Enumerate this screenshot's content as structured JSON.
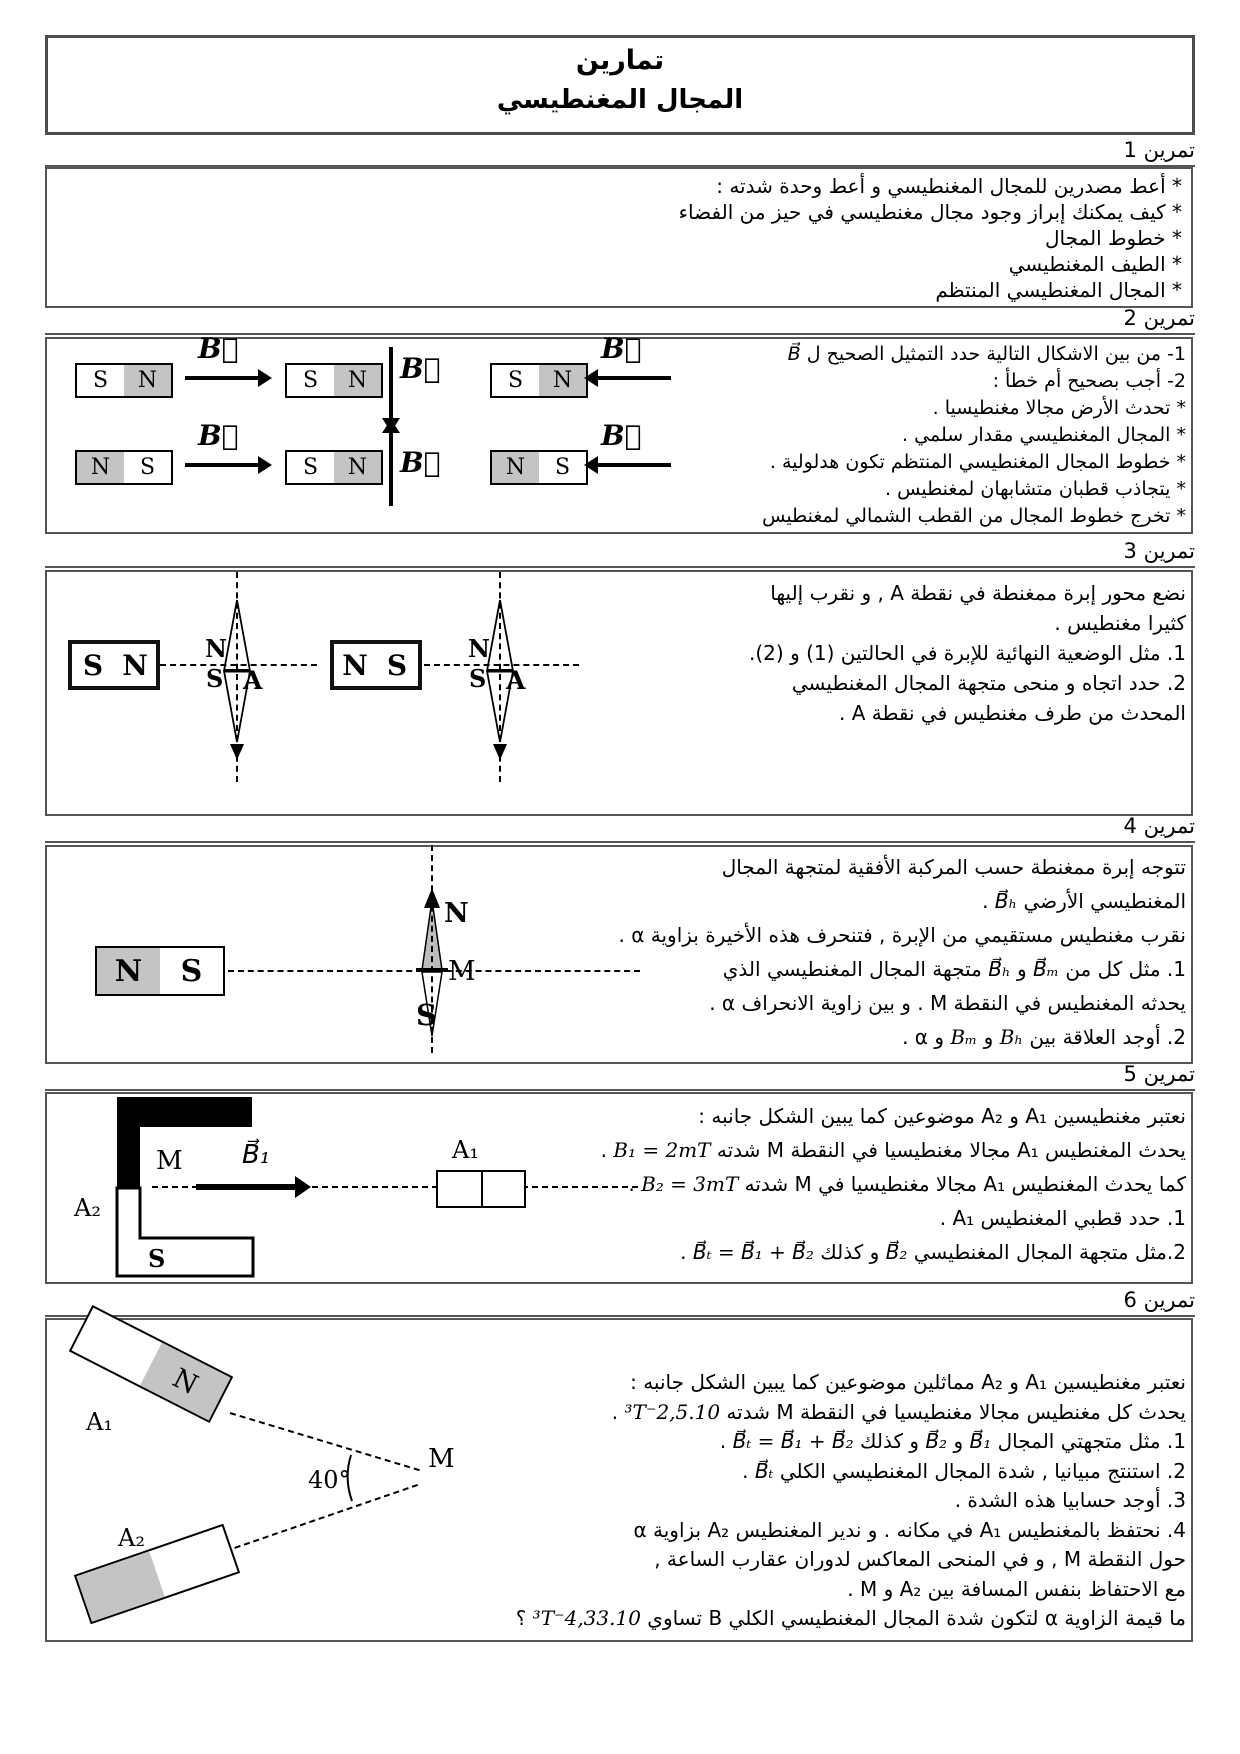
{
  "labels": {
    "vec_b": "B⃗"
  },
  "title": {
    "line1": "تمارين",
    "line2": "المجال المغنطيسي"
  },
  "ex1": {
    "heading": "تمرين 1",
    "lines": [
      {
        "t": "* أعط مصدرين للمجال المغنطيسي و أعط وحدة شدته :"
      },
      {
        "t": "* كيف يمكنك إبراز وجود مجال مغنطيسي في حيز من الفضاء"
      },
      {
        "t": "* خطوط المجال"
      },
      {
        "t": "* الطيف المغنطيسي"
      },
      {
        "t": "* المجال المغنطيسي المنتظم"
      }
    ]
  },
  "ex2": {
    "heading": "تمرين 2",
    "lines": [
      {
        "a": "1- من بين الاشكال التالية حدد التمثيل الصحيح ل ",
        "f": "B⃗"
      },
      {
        "t": "2- أجب بصحيح أم خطأ :"
      },
      {
        "t": "* تحدث الأرض مجالا مغنطيسيا ."
      },
      {
        "t": "* المجال المغنطيسي مقدار سلمي ."
      },
      {
        "t": "* خطوط المجال المغنطيسي المنتظم تكون هدلولية ."
      },
      {
        "t": "* يتجاذب قطبان متشابهان لمغنطيس ."
      },
      {
        "t": "* تخرج خطوط المجال من القطب الشمالي لمغنطيس"
      }
    ],
    "magnets": [
      {
        "left": "S",
        "right": "N",
        "shaded": "right",
        "arrow": "right"
      },
      {
        "left": "S",
        "right": "N",
        "shaded": "right",
        "arrow": "down"
      },
      {
        "left": "S",
        "right": "N",
        "shaded": "right",
        "arrow": "left"
      },
      {
        "left": "N",
        "right": "S",
        "shaded": "left",
        "arrow": "right"
      },
      {
        "left": "S",
        "right": "N",
        "shaded": "right",
        "arrow": "up"
      },
      {
        "left": "N",
        "right": "S",
        "shaded": "left",
        "arrow": "left"
      }
    ]
  },
  "ex3": {
    "heading": "تمرين 3",
    "lines": [
      {
        "t": "نضع محور إبرة ممغنطة في نقطة A , و نقرب إليها"
      },
      {
        "t": "كثيرا مغنطيس ."
      },
      {
        "t": "1. مثل الوضعية النهائية للإبرة في الحالتين (1) و (2)."
      },
      {
        "t": "2. حدد اتجاه و منحى متجهة المجال المغنطيسي"
      },
      {
        "t": "المحدث من طرف مغنطيس في نقطة A ."
      }
    ],
    "fig": {
      "magnet1": {
        "left": "S",
        "right": "N"
      },
      "magnet2": {
        "left": "N",
        "right": "S"
      },
      "needle": {
        "n": "N",
        "s": "S",
        "a": "A"
      }
    }
  },
  "ex4": {
    "heading": "تمرين 4",
    "lines": [
      {
        "t": "تتوجه إبرة ممغنطة حسب المركبة الأفقية لمتجهة المجال"
      },
      {
        "a": "المغنطيسي الأرضي ",
        "f": "B⃗ₕ",
        "b": " ."
      },
      {
        "t": "نقرب مغنطيس مستقيمي من الإبرة , فتنحرف هذه الأخيرة بزاوية α ."
      },
      {
        "a": "1. مثل كل من ",
        "f": "B⃗ₘ",
        "b": " و ",
        "f2": "B⃗ₕ",
        "c": " متجهة المجال المغنطيسي الذي"
      },
      {
        "t": "يحدثه المغنطيس في النقطة M . و بين زاوية الانحراف α ."
      },
      {
        "a": "2. أوجد العلاقة بين ",
        "f": "Bₕ",
        "b": " و ",
        "f2": "Bₘ",
        "c": " و α ."
      }
    ],
    "fig": {
      "magnet": {
        "left": "N",
        "right": "S"
      },
      "n": "N",
      "s": "S",
      "m": "M"
    }
  },
  "ex5": {
    "heading": "تمرين 5",
    "lines": [
      {
        "t": "نعتبر مغنطيسين A₁ و A₂ موضوعين كما يبين الشكل جانبه :"
      },
      {
        "a": "يحدث المغنطيس A₁ مجالا مغنطيسيا في النقطة M شدته ",
        "f": "B₁ = 2mT",
        "b": " ."
      },
      {
        "a": "كما يحدث المغنطيس A₁ مجالا مغنطيسيا في M شدته ",
        "f": "B₂ = 3mT",
        "b": " ."
      },
      {
        "t": "1. حدد قطبي المغنطيس A₁ ."
      },
      {
        "a": "2.مثل متجهة المجال المغنطيسي ",
        "f": "B⃗₂",
        "b": " و كذلك ",
        "f2": "B⃗ₜ = B⃗₁ + B⃗₂",
        "c": " ."
      }
    ],
    "fig": {
      "a2": "A₂",
      "m": "M",
      "b1": "B⃗₁",
      "s": "S",
      "a1": "A₁"
    }
  },
  "ex6": {
    "heading": "تمرين 6",
    "lines": [
      {
        "t": "نعتبر مغنطيسين A₁ و A₂ مماثلين موضوعين كما يبين الشكل جانبه :"
      },
      {
        "a": "يحدث كل مغنطيس مجالا مغنطيسيا في النقطة M شدته ",
        "f": "2,5.10⁻³T",
        "b": " ."
      },
      {
        "a": "1. مثل متجهتي المجال ",
        "f": "B⃗₁",
        "b": " و ",
        "f2": "B⃗₂",
        "c": " و كذلك ",
        "f3": "B⃗ₜ = B⃗₁ + B⃗₂",
        "d": " ."
      },
      {
        "a": "2. استنتج مبيانيا , شدة المجال المغنطيسي الكلي ",
        "f": "B⃗ₜ",
        "b": " ."
      },
      {
        "t": "3. أوجد حسابيا هذه الشدة ."
      },
      {
        "t": "4. نحتفظ بالمغنطيس A₁ في مكانه . و ندير المغنطيس A₂ بزاوية α"
      },
      {
        "t": "حول النقطة M , و في المنحى المعاكس لدوران عقارب الساعة ,"
      },
      {
        "t": "مع الاحتفاظ بنفس المسافة بين A₂ و M ."
      },
      {
        "a": "ما قيمة الزاوية α لتكون شدة المجال المغنطيسي الكلي B تساوي ",
        "f": "4,33.10⁻³T",
        "b": " ؟"
      }
    ],
    "fig": {
      "a1": "A₁",
      "n": "N",
      "m": "M",
      "angle": "40°",
      "a2": "A₂"
    }
  }
}
